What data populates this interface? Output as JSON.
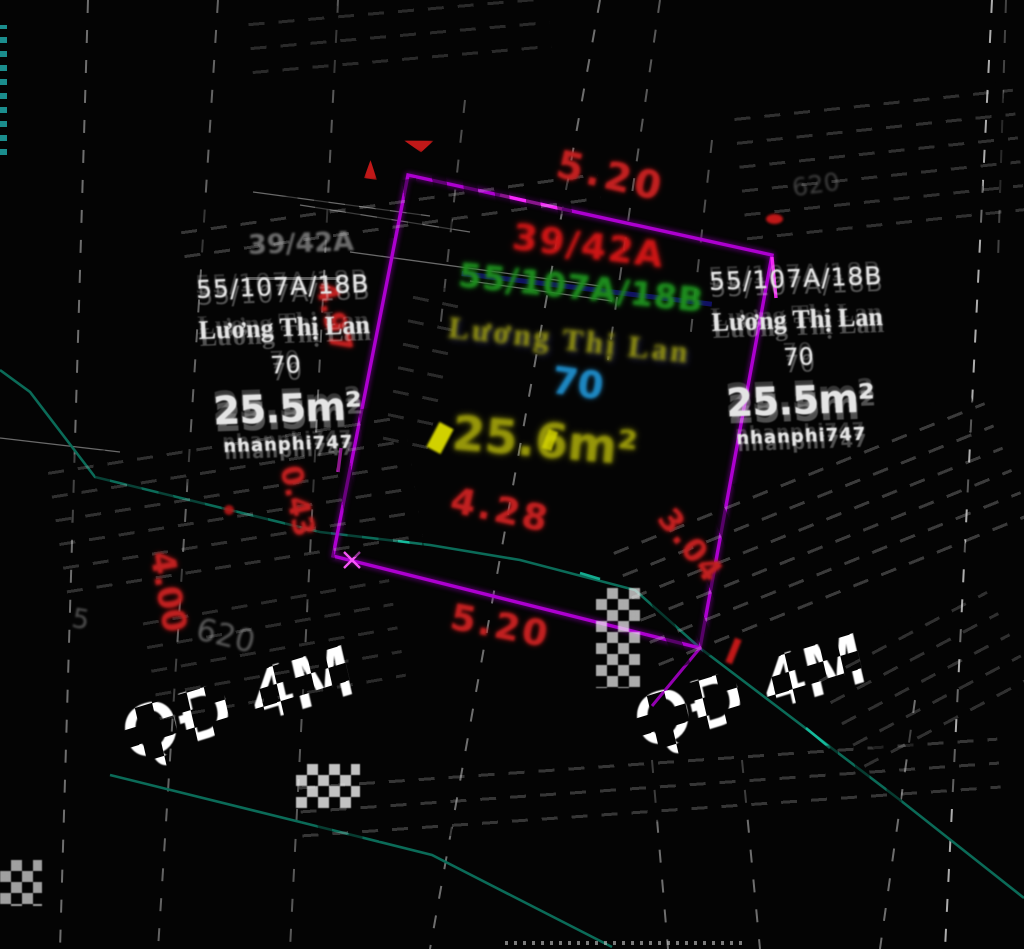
{
  "canvas": {
    "title": "cadastral-cad-view",
    "width": 1024,
    "height": 949
  },
  "colors": {
    "background": "#040404",
    "parcel_boundary": "#ad00d0",
    "parcel_boundary_bright": "#ff2bff",
    "road_line": "#0b6b58",
    "dimension_text": "#c02020",
    "plot_number": "#cc1515",
    "address_text": "#1e8c1e",
    "owner_text": "#8e8e12",
    "land_code_text": "#1d86c0",
    "area_text": "#96960a",
    "ghost_text": "#e4e4e4",
    "dashed_parcel_lines": "#d8d8d8"
  },
  "parcel": {
    "plot_number": "39/42A",
    "address": "55/107A/18B",
    "owner": "Lương Thị Lan",
    "land_code": "70",
    "area": "25.6m²",
    "dim_top": "5.20",
    "dim_bottom": "5.20",
    "dim_inner": "4.28",
    "dim_right": "3.04",
    "dim_left": "4.97",
    "dim_left_lower": "0.43",
    "dim_far_left": "4.00"
  },
  "ghost_left": {
    "address": "55/107A/18B",
    "owner": "Lương Thị Lan",
    "land_code": "70",
    "area": "25.5m²",
    "watermark": "nhanphi747"
  },
  "ghost_right": {
    "address": "55/107A/18B",
    "owner": "Lương Thị Lan",
    "land_code": "70",
    "area": "25.5m²",
    "watermark": "nhanphi747"
  },
  "gray_ghosts": {
    "plot_number": "39/42A",
    "n620_left": "620",
    "n620_right": "620",
    "n5": "5"
  },
  "road_labels": {
    "left": "QĐ 4M",
    "right": "QĐ 4M"
  }
}
